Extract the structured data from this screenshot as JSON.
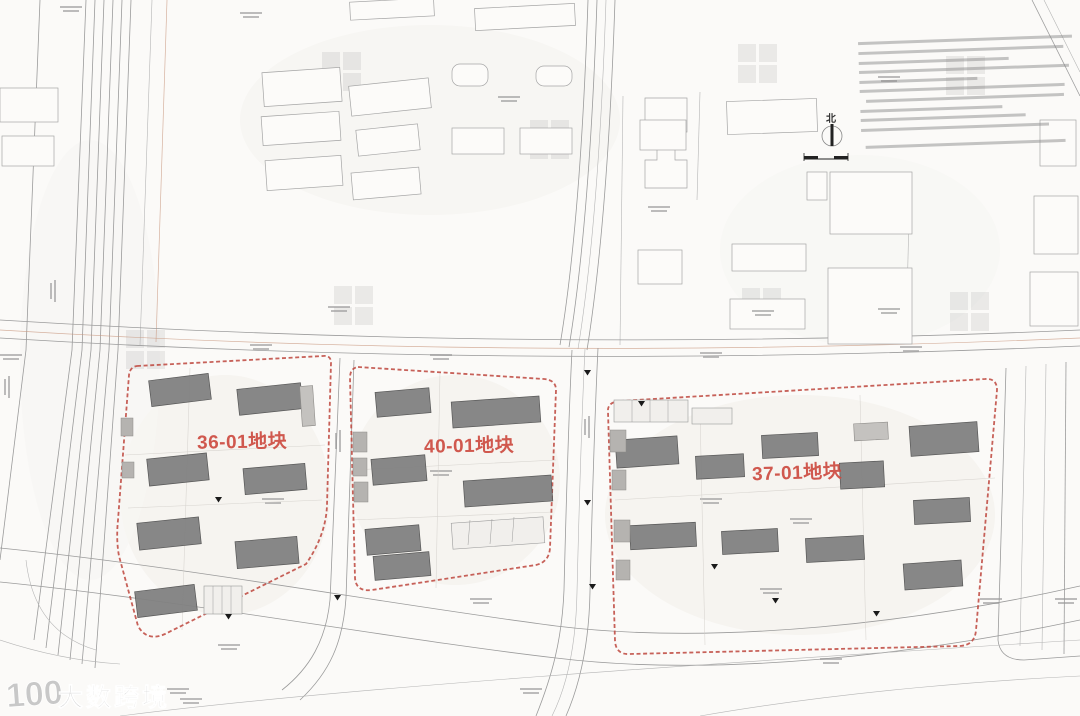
{
  "drawing": {
    "plots": [
      {
        "id": "36-01",
        "label": "36-01地块"
      },
      {
        "id": "40-01",
        "label": "40-01地块"
      },
      {
        "id": "37-01",
        "label": "37-01地块"
      }
    ],
    "north_indicator": {
      "label": "北"
    },
    "watermark": {
      "logo_number": "100",
      "brand": "大数跨境"
    },
    "colors": {
      "paper": "#fbfaf8",
      "boundary_red": "#bf4b42",
      "label_red": "#cd4a40",
      "building_gray": "#818181",
      "line_gray": "#9b9b9b"
    }
  }
}
